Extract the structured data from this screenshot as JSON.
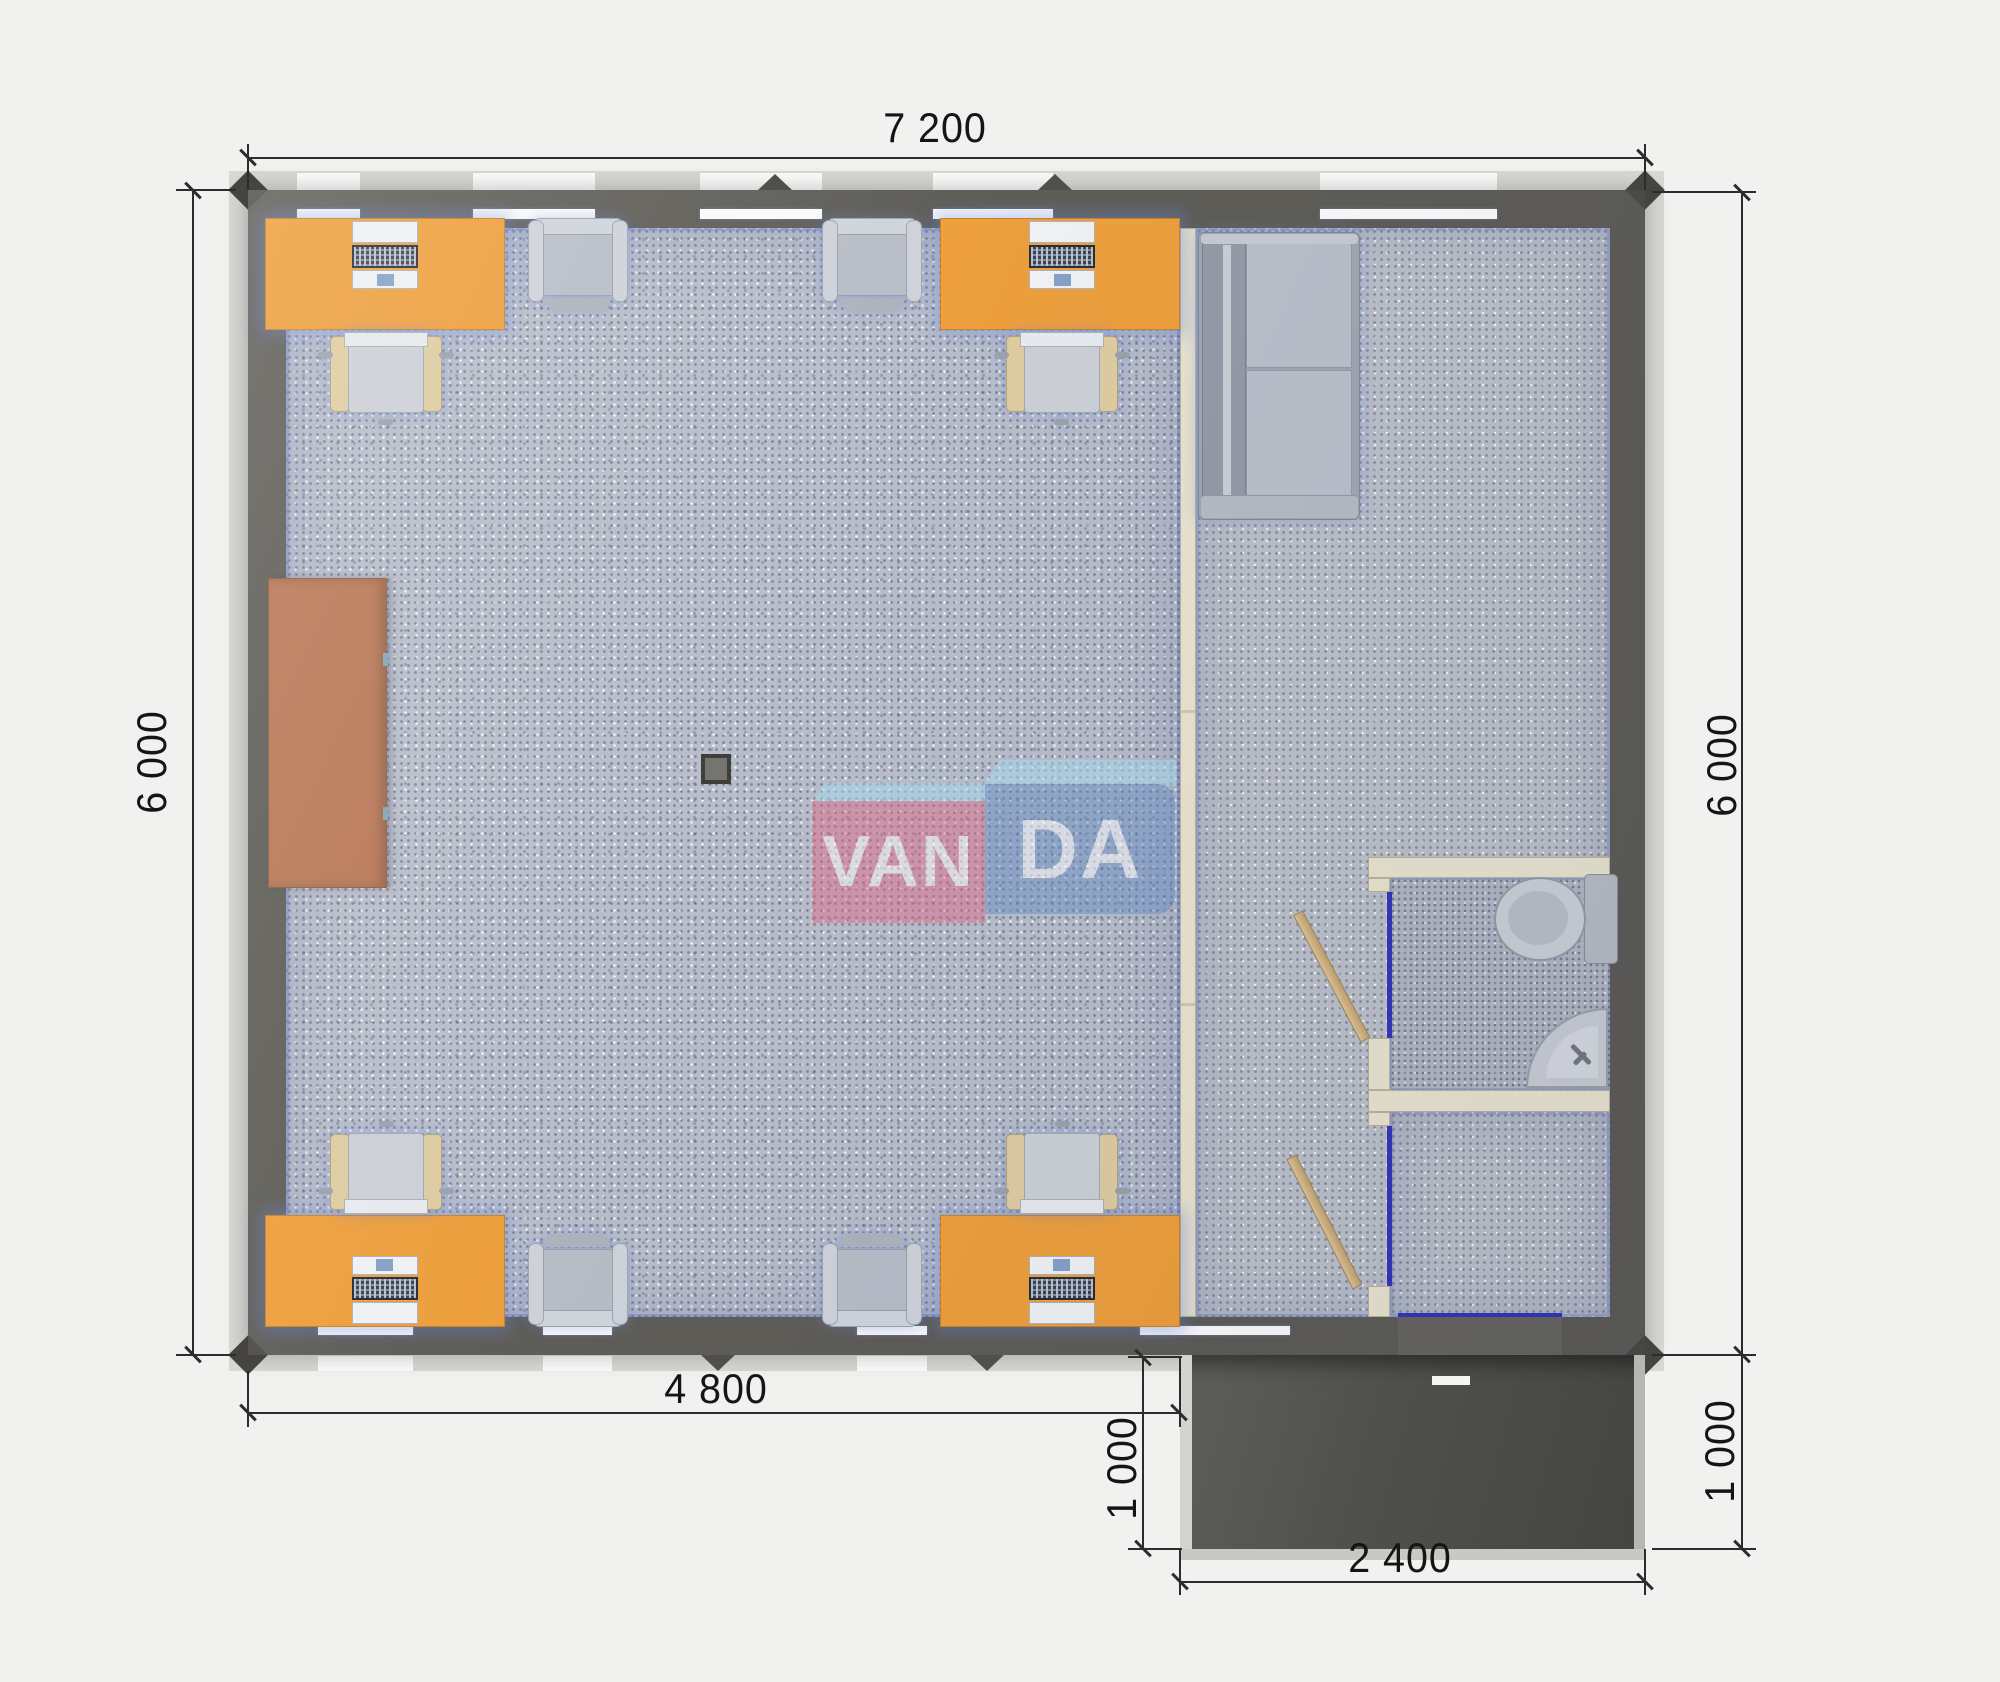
{
  "brand": {
    "watermark_left": "VAN",
    "watermark_right": "DA",
    "full_name": "VANDA"
  },
  "dimensions": {
    "overall_width": "7 200",
    "left_height": "6 000",
    "right_height": "6 000",
    "office_width": "4 800",
    "porch_depth_left": "1 000",
    "porch_depth_right": "1 000",
    "porch_width": "2 400"
  },
  "colors": {
    "exterior_wall": "#57554f",
    "floor_carpet": "#b5bac7",
    "desk_orange": "#ec9a33",
    "cabinet_brown": "#b5714e",
    "door_frame_blue": "#2d2db2",
    "door_wood": "#d4b27e",
    "logo_pink": "#df6580",
    "logo_blue": "#648ac2",
    "logo_roof_lightblue": "#a5d8ec",
    "porch_dark": "#4f4f4c"
  },
  "legend": {
    "furniture": [
      "office-desk",
      "desktop-computer",
      "office-chair",
      "guest-armchair",
      "sofa",
      "storage-cabinet",
      "toilet",
      "corner-sink",
      "interior-door",
      "entrance-door",
      "entrance-porch",
      "floor-service-box"
    ]
  }
}
